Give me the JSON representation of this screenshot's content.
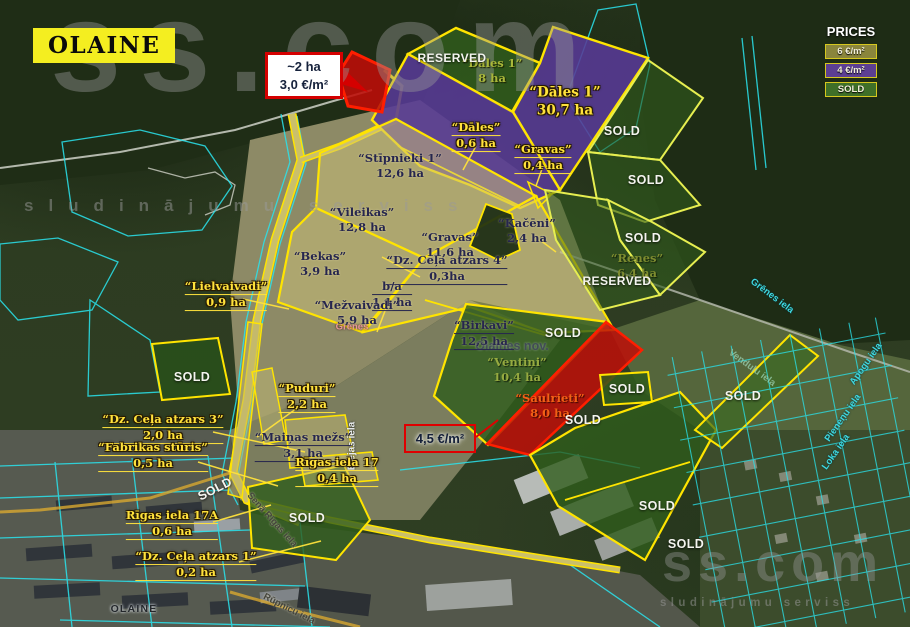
{
  "brand": {
    "name": "ss.com",
    "tagline": "sludinājumu serviss"
  },
  "title_badge": "OLAINE",
  "legend": {
    "title": "PRICES",
    "items": [
      {
        "label": "6 €/m²",
        "color": "#8a853c"
      },
      {
        "label": "4 €/m²",
        "color": "#5c3f92"
      },
      {
        "label": "SOLD",
        "color": "#3f6f28"
      }
    ]
  },
  "status": {
    "sold": "SOLD",
    "reserved": "RESERVED"
  },
  "callouts": {
    "top": {
      "l1": "~2 ha",
      "l2": "3,0 €/m²"
    },
    "mid": {
      "l1": "4,5 €/m²"
    }
  },
  "parcels": [
    {
      "name": "“Dāles 1”",
      "area": "8 ha"
    },
    {
      "name": "“Dāles 1”",
      "area": "30,7 ha"
    },
    {
      "name": "“Dāles”",
      "area": "0,6 ha"
    },
    {
      "name": "“Gravas”",
      "area": "0,4 ha"
    },
    {
      "name": "“Stīpnieki 1”",
      "area": "12,6 ha"
    },
    {
      "name": "“Vileikas”",
      "area": "12,8 ha"
    },
    {
      "name": "“Gravas”",
      "area": "11,6 ha"
    },
    {
      "name": "“Kačēni”",
      "area": "2,4 ha"
    },
    {
      "name": "“Bekas”",
      "area": "3,9 ha"
    },
    {
      "name": "“Dz. Ceļa atzars 4”",
      "area": "0,3ha"
    },
    {
      "name": "b/a",
      "area": "1,1 ha"
    },
    {
      "name": "“Lielvaivadi”",
      "area": "0,9 ha"
    },
    {
      "name": "“Mežvaivadi”",
      "area": "5,9 ha"
    },
    {
      "name": "“Birkavi”",
      "area": "12,5 ha"
    },
    {
      "name": "“Renes”",
      "area": "6,4 ha"
    },
    {
      "name": "“Ventiņi”",
      "area": "10,4 ha"
    },
    {
      "name": "“Saulrieti”",
      "area": "8,0 ha"
    },
    {
      "name": "“Puduri”",
      "area": "2,2 ha"
    },
    {
      "name": "“Dz. Ceļa atzars 3”",
      "area": "2,0 ha"
    },
    {
      "name": "“Fabrikas stūris”",
      "area": "0,5 ha"
    },
    {
      "name": "“Maiņas mežs”",
      "area": "3,1 ha"
    },
    {
      "name": "Rīgas iela 17",
      "area": "0,4 ha"
    },
    {
      "name": "Rīgas iela 17A",
      "area": "0,6 ha"
    },
    {
      "name": "“Dz. Ceļa atzars 1”",
      "area": "0,2 ha"
    }
  ],
  "map_labels": {
    "municipality": "Olaines nov.",
    "town": "OLAINE",
    "grenes": "Grēnes"
  },
  "streets": [
    {
      "label": "Elejas iela"
    },
    {
      "label": "Grēnes iela"
    },
    {
      "label": "Apogu iela"
    },
    {
      "label": "Pieneņu iela"
    },
    {
      "label": "Loka iela"
    },
    {
      "label": "Venduļu iela"
    },
    {
      "label": "Senā Rīgas iela"
    },
    {
      "label": "Rūpnīcu iela"
    }
  ]
}
